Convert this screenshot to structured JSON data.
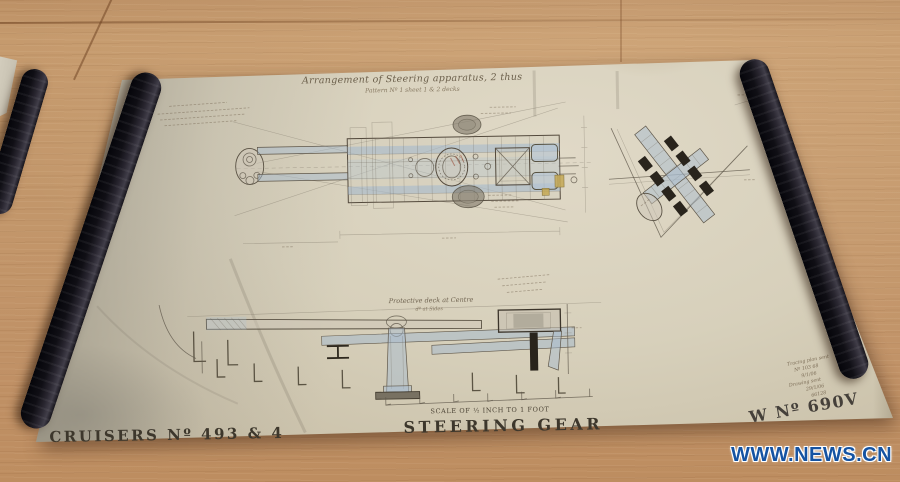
{
  "scene": {
    "watermark": "WWW.NEWS.CN"
  },
  "drawing": {
    "title": "Arrangement of Steering apparatus, 2 thus",
    "subtitle": "Pattern Nº 1 sheet 1 & 2 decks",
    "plan_note": "Protective deck at Centre",
    "plan_note2": "dº at Sides",
    "scale_note": "SCALE OF ½ INCH TO 1 FOOT",
    "name_left": "CRUISERS Nº 493 & 4",
    "name_center": "STEERING GEAR",
    "name_right": "W Nº 690V",
    "stamp_lines": [
      "Tracing plan sent",
      "Nº 103 68",
      "9/1/06",
      "Drawing sent",
      "29/1/06",
      "66128"
    ],
    "colors": {
      "ink": "#5f574a",
      "blue_wash": "#a9bccd",
      "paper": "#d5cdb9",
      "wood": "#c2966a",
      "watermark_blue": "#1553a2"
    }
  }
}
